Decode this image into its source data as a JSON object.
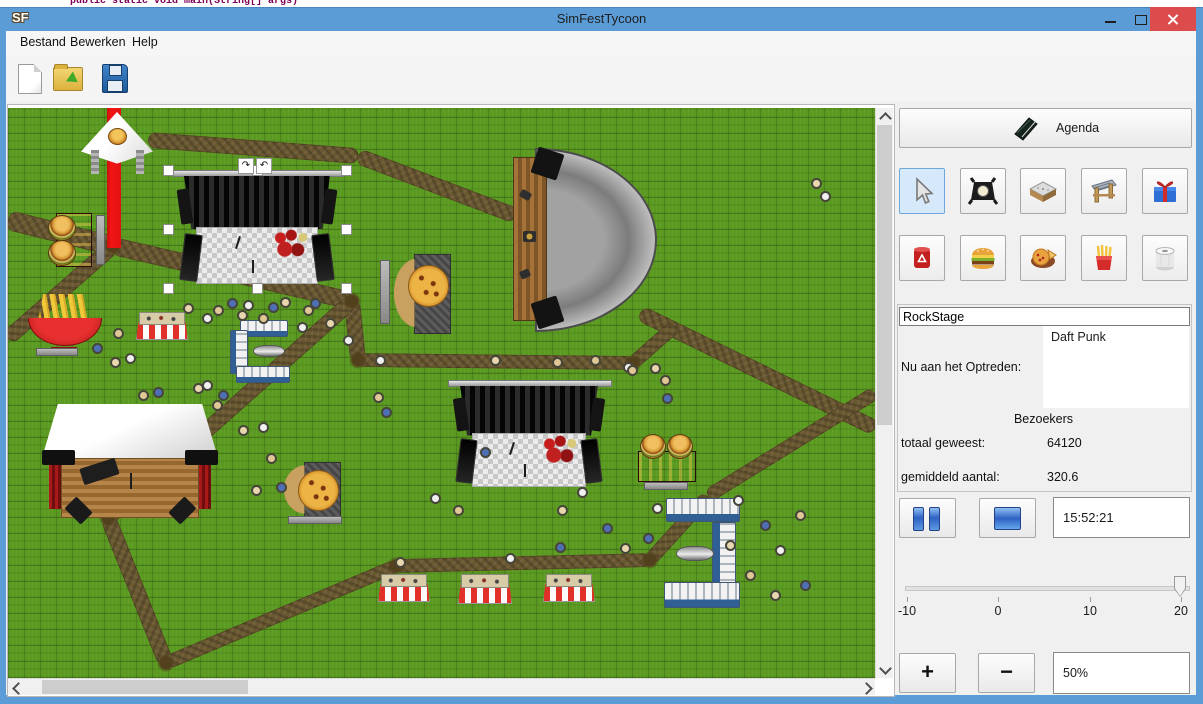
{
  "background_code": "public static void main(String[] args)",
  "window": {
    "title": "SimFestTycoon",
    "app_icon": "SF"
  },
  "menu": {
    "items": [
      "Bestand",
      "Bewerken",
      "Help"
    ]
  },
  "toolbar": {
    "buttons": [
      "new-document",
      "open-file",
      "save-file"
    ]
  },
  "sidebar": {
    "agenda_label": "Agenda",
    "tools_row1": [
      "select",
      "spotlight",
      "stage",
      "entrance-gate",
      "gift"
    ],
    "tools_row2": [
      "trash-bin",
      "burger-stand",
      "pizza-stand",
      "fries-stand",
      "toilet"
    ],
    "selected_tool": "select",
    "stage_name_value": "RockStage",
    "now_performing_label": "Nu aan het Optreden:",
    "now_performing_value": "Daft Punk",
    "visitors_heading": "Bezoekers",
    "total_label": "totaal geweest:",
    "total_value": "64120",
    "average_label": "gemiddeld aantal:",
    "average_value": "320.6",
    "time_value": "15:52:21",
    "speed_slider": {
      "min": -10,
      "max": 20,
      "value": 20,
      "ticks": [
        "-10",
        "0",
        "10",
        "20"
      ]
    },
    "zoom_in_label": "+",
    "zoom_out_label": "−",
    "zoom_value": "50%"
  },
  "map": {
    "paths": [
      {
        "x1": 0,
        "y1": 112,
        "x2": 105,
        "y2": 138,
        "w": 20
      },
      {
        "x1": 105,
        "y1": 138,
        "x2": 344,
        "y2": 193,
        "w": 18
      },
      {
        "x1": 140,
        "y1": 32,
        "x2": 350,
        "y2": 48,
        "w": 16
      },
      {
        "x1": 350,
        "y1": 48,
        "x2": 508,
        "y2": 108,
        "w": 16
      },
      {
        "x1": 632,
        "y1": 205,
        "x2": 867,
        "y2": 320,
        "w": 16
      },
      {
        "x1": 344,
        "y1": 193,
        "x2": 350,
        "y2": 252,
        "w": 16
      },
      {
        "x1": 350,
        "y1": 252,
        "x2": 625,
        "y2": 255,
        "w": 14
      },
      {
        "x1": 625,
        "y1": 255,
        "x2": 667,
        "y2": 218,
        "w": 14
      },
      {
        "x1": 344,
        "y1": 193,
        "x2": 100,
        "y2": 410,
        "w": 16
      },
      {
        "x1": 100,
        "y1": 410,
        "x2": 158,
        "y2": 555,
        "w": 16
      },
      {
        "x1": 158,
        "y1": 555,
        "x2": 388,
        "y2": 458,
        "w": 14
      },
      {
        "x1": 388,
        "y1": 458,
        "x2": 642,
        "y2": 452,
        "w": 14
      },
      {
        "x1": 642,
        "y1": 452,
        "x2": 700,
        "y2": 388,
        "w": 14
      },
      {
        "x1": 700,
        "y1": 388,
        "x2": 867,
        "y2": 285,
        "w": 14
      },
      {
        "x1": 105,
        "y1": 138,
        "x2": 0,
        "y2": 230,
        "w": 16
      }
    ],
    "junctions": [
      [
        105,
        138
      ],
      [
        344,
        193
      ],
      [
        350,
        252
      ],
      [
        100,
        410
      ],
      [
        158,
        555
      ],
      [
        388,
        458
      ],
      [
        642,
        452
      ],
      [
        625,
        255
      ]
    ],
    "objects": [
      {
        "type": "red-stripe",
        "name": "entrance-carpet",
        "x": 99,
        "y": 0,
        "w": 14,
        "h": 140
      },
      {
        "type": "tent",
        "name": "food-tent",
        "x": 73,
        "y": 4,
        "w": 72,
        "h": 68
      },
      {
        "type": "burger-stand-v",
        "name": "burger-stand",
        "x": 40,
        "y": 105,
        "w": 42,
        "h": 52
      },
      {
        "type": "bench-v",
        "name": "bench",
        "x": 88,
        "y": 107,
        "w": 7,
        "h": 48
      },
      {
        "type": "bench-v",
        "name": "bench",
        "x": 250,
        "y": 107,
        "w": 7,
        "h": 48
      },
      {
        "type": "stage-black",
        "name": "rock-stage",
        "x": 160,
        "y": 62,
        "w": 178,
        "h": 118,
        "selected": true
      },
      {
        "type": "dome",
        "name": "dome-stage",
        "x": 505,
        "y": 40,
        "w": 140,
        "h": 180
      },
      {
        "type": "fries",
        "name": "fries-stand",
        "x": 20,
        "y": 186,
        "w": 72,
        "h": 58
      },
      {
        "type": "bench-h",
        "name": "bench",
        "x": 28,
        "y": 240,
        "w": 40,
        "h": 6
      },
      {
        "type": "stand-striped",
        "name": "market-stand",
        "x": 128,
        "y": 204,
        "w": 50,
        "h": 26
      },
      {
        "type": "toilet-strip-h",
        "name": "toilet-row",
        "x": 232,
        "y": 212,
        "w": 46,
        "h": 15
      },
      {
        "type": "toilet-strip-v",
        "name": "toilet-row",
        "x": 222,
        "y": 222,
        "w": 16,
        "h": 42
      },
      {
        "type": "toilet-strip-h",
        "name": "toilet-row",
        "x": 228,
        "y": 258,
        "w": 52,
        "h": 15
      },
      {
        "type": "pipe",
        "name": "pipe",
        "x": 245,
        "y": 237,
        "w": 30,
        "h": 10
      },
      {
        "type": "bench-v",
        "name": "bench",
        "x": 372,
        "y": 152,
        "w": 8,
        "h": 62
      },
      {
        "type": "pizza",
        "name": "pizza-stand",
        "x": 386,
        "y": 146,
        "w": 62,
        "h": 78
      },
      {
        "type": "acoustic",
        "name": "acoustic-stage",
        "x": 34,
        "y": 296,
        "w": 176,
        "h": 115
      },
      {
        "type": "pizza",
        "name": "pizza-table",
        "x": 276,
        "y": 354,
        "w": 62,
        "h": 55
      },
      {
        "type": "bench-h",
        "name": "bench",
        "x": 280,
        "y": 408,
        "w": 52,
        "h": 6
      },
      {
        "type": "stage-black",
        "name": "main-stage",
        "x": 437,
        "y": 272,
        "w": 168,
        "h": 110
      },
      {
        "type": "burger-stand-h",
        "name": "burger-stand",
        "x": 630,
        "y": 326,
        "w": 56,
        "h": 46
      },
      {
        "type": "bench-h",
        "name": "bench",
        "x": 636,
        "y": 374,
        "w": 42,
        "h": 6
      },
      {
        "type": "toilet-strip-h",
        "name": "toilet-row",
        "x": 658,
        "y": 390,
        "w": 72,
        "h": 22
      },
      {
        "type": "toilet-strip-v",
        "name": "toilet-row",
        "x": 704,
        "y": 414,
        "w": 22,
        "h": 64
      },
      {
        "type": "toilet-strip-h",
        "name": "toilet-row",
        "x": 656,
        "y": 474,
        "w": 74,
        "h": 24
      },
      {
        "type": "pipe",
        "name": "pipe",
        "x": 668,
        "y": 438,
        "w": 36,
        "h": 13
      },
      {
        "type": "stand-striped",
        "name": "market-stand",
        "x": 370,
        "y": 466,
        "w": 50,
        "h": 26
      },
      {
        "type": "stand-striped",
        "name": "market-stand",
        "x": 450,
        "y": 466,
        "w": 52,
        "h": 28
      },
      {
        "type": "stand-striped",
        "name": "market-stand",
        "x": 535,
        "y": 466,
        "w": 50,
        "h": 26
      }
    ],
    "note_icons": [
      {
        "x": 230,
        "y": 50,
        "glyph": "↷"
      },
      {
        "x": 248,
        "y": 50,
        "glyph": "↶"
      }
    ],
    "people": [
      [
        175,
        195
      ],
      [
        194,
        205
      ],
      [
        205,
        197
      ],
      [
        219,
        190
      ],
      [
        229,
        202
      ],
      [
        235,
        192
      ],
      [
        250,
        205
      ],
      [
        260,
        194
      ],
      [
        272,
        189
      ],
      [
        289,
        214
      ],
      [
        295,
        197
      ],
      [
        302,
        190
      ],
      [
        317,
        210
      ],
      [
        335,
        227
      ],
      [
        105,
        220
      ],
      [
        84,
        235
      ],
      [
        102,
        249
      ],
      [
        117,
        245
      ],
      [
        130,
        282
      ],
      [
        145,
        279
      ],
      [
        185,
        275
      ],
      [
        194,
        272
      ],
      [
        204,
        292
      ],
      [
        210,
        282
      ],
      [
        230,
        317
      ],
      [
        250,
        314
      ],
      [
        258,
        345
      ],
      [
        268,
        374
      ],
      [
        243,
        377
      ],
      [
        367,
        247
      ],
      [
        365,
        284
      ],
      [
        373,
        299
      ],
      [
        387,
        449
      ],
      [
        422,
        385
      ],
      [
        445,
        397
      ],
      [
        472,
        339
      ],
      [
        482,
        247
      ],
      [
        497,
        445
      ],
      [
        544,
        249
      ],
      [
        547,
        434
      ],
      [
        549,
        397
      ],
      [
        569,
        379
      ],
      [
        582,
        247
      ],
      [
        594,
        415
      ],
      [
        612,
        435
      ],
      [
        615,
        254
      ],
      [
        619,
        257
      ],
      [
        635,
        425
      ],
      [
        642,
        255
      ],
      [
        644,
        395
      ],
      [
        652,
        267
      ],
      [
        654,
        285
      ],
      [
        717,
        432
      ],
      [
        725,
        387
      ],
      [
        737,
        462
      ],
      [
        752,
        412
      ],
      [
        762,
        482
      ],
      [
        767,
        437
      ],
      [
        787,
        402
      ],
      [
        792,
        472
      ],
      [
        803,
        70
      ],
      [
        812,
        83
      ]
    ]
  }
}
